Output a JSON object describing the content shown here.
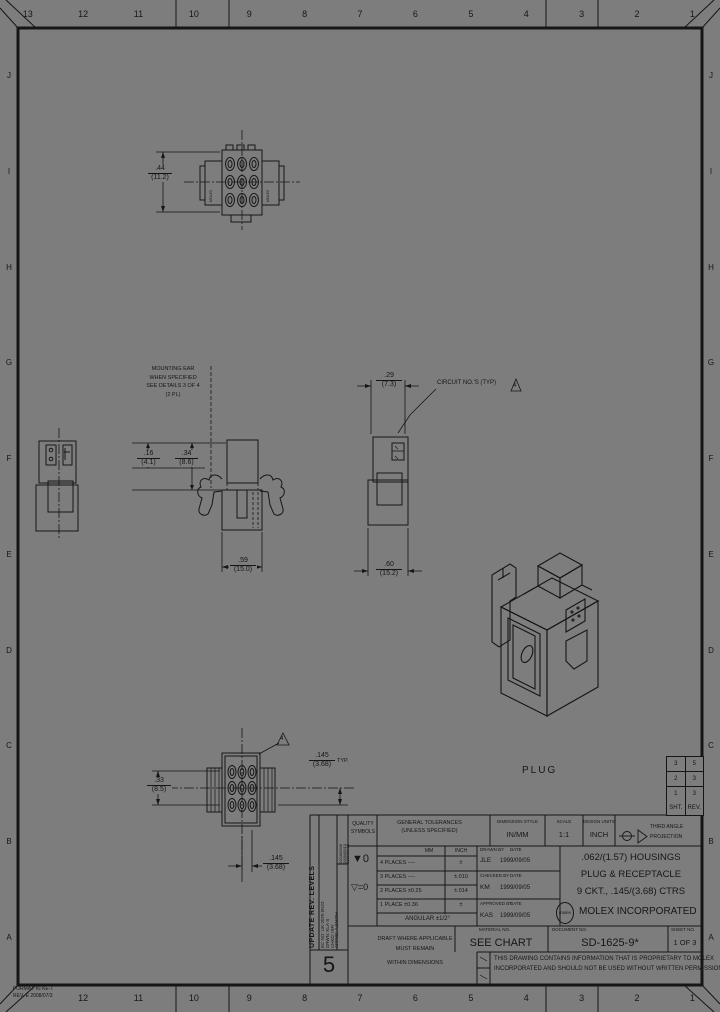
{
  "border": {
    "top_numbers": [
      "13",
      "12",
      "11",
      "10",
      "9",
      "8",
      "7",
      "6",
      "5",
      "4",
      "3",
      "2",
      "1"
    ],
    "bottom_numbers": [
      "",
      "12",
      "11",
      "10",
      "9",
      "8",
      "7",
      "6",
      "5",
      "4",
      "3",
      "2",
      "1"
    ],
    "left_letters": [
      "J",
      "I",
      "H",
      "G",
      "F",
      "E",
      "D",
      "C",
      "B",
      "A"
    ],
    "right_letters": [
      "J",
      "I",
      "H",
      "G",
      "F",
      "E",
      "D",
      "C",
      "B",
      "A"
    ]
  },
  "corner_note": {
    "line1": "FORMAT: KI KE-T",
    "line2": "REV. E 2008/07/3"
  },
  "views": {
    "receptacle_front": {
      "rail_left": "MOLEX",
      "rail_right": "MOLEX",
      "dim_width": {
        "in": ".44",
        "mm": "(11.2)"
      }
    },
    "mounting_note": {
      "lines": [
        "MOUNTING EAR",
        "WHEN SPECIFIED",
        "SEE DETAILS 3 OF 4",
        "(2 PL)"
      ]
    },
    "side_view": {
      "dim_a": {
        "in": ".16",
        "mm": "(4.1)"
      },
      "dim_b": {
        "in": ".34",
        "mm": "(8.6)"
      },
      "dim_bottom": {
        "in": ".59",
        "mm": "(15.0)"
      }
    },
    "pin_view": {
      "dim_top": {
        "in": ".29",
        "mm": "(7.3)"
      },
      "dim_bottom": {
        "in": ".60",
        "mm": "(15.2)"
      },
      "note": "CIRCUIT NO.'S (TYP)",
      "tri": "4"
    },
    "plug_front": {
      "dim_left": {
        "in": ".33",
        "mm": "(8.5)"
      },
      "dim_pitch": {
        "in": ".145",
        "mm": "(3.68)",
        "suffix": "TYP."
      },
      "dim_pitch2": {
        "in": ".145",
        "mm": "(3.68)"
      },
      "tri": "4"
    },
    "iso_label": "PLUG"
  },
  "rev_table": {
    "rows": [
      [
        "3",
        "5"
      ],
      [
        "2",
        "3"
      ],
      [
        "1",
        "3"
      ]
    ],
    "footer": {
      "sht": "SHT.",
      "rev": "REV."
    }
  },
  "title_block": {
    "update_strip": {
      "title": "UPDATE REV. LEVELS",
      "ec_no": "EC NO: UK-2070 0N23",
      "drwn": "DRWN: KLA-S",
      "chkd": "CHKD: ISFI",
      "appvd": "APPVD: A.SMITH",
      "dates": [
        "2004/09/06",
        "2009/09/13",
        "2009/09/15"
      ],
      "rev": "5"
    },
    "quality": {
      "header1": "QUALITY",
      "header2": "SYMBOLS",
      "sym1": "▼0",
      "sym2": "▽=0"
    },
    "tolerances": {
      "header1": "GENERAL TOLERANCES",
      "header2": "(UNLESS SPECIFIED)",
      "col_mm": "MM",
      "col_inch": "INCH",
      "rows": [
        [
          "4 PLACES ----",
          "±"
        ],
        [
          "3 PLACES ----",
          "±.010"
        ],
        [
          "2 PLACES ±0.25",
          "±.014"
        ],
        [
          "1 PLACE ±0.36",
          "±"
        ]
      ],
      "angular": "ANGULAR ±1/2°"
    },
    "dimension_style": {
      "label": "DIMENSION STYLE",
      "value": "IN/MM"
    },
    "scale": {
      "label": "SCALE",
      "value": "1:1"
    },
    "design_units": {
      "label": "DESIGN UNITS",
      "value": "INCH"
    },
    "projection": {
      "line1": "THIRD ANGLE",
      "line2": "PROJECTION"
    },
    "signatures": {
      "drawn_label": "DRAWN BY",
      "date_label": "DATE",
      "drawn_by": "JLE",
      "drawn_date": "1999/09/05",
      "checked_label": "CHECKED BY",
      "checked_by": "KM",
      "checked_date": "1999/09/05",
      "approved_label": "APPROVED BY",
      "approved_by": "KAS",
      "approved_date": "1999/09/05"
    },
    "title": {
      "line1": ".062/(1.57) HOUSINGS",
      "line2": "PLUG & RECEPTACLE",
      "line3": "9 CKT., .145/(3.68) CTRS"
    },
    "company": {
      "logo": "molex",
      "name": "MOLEX INCORPORATED"
    },
    "material": {
      "label": "MATERIAL NO.",
      "value": "SEE CHART"
    },
    "document": {
      "label": "DOCUMENT NO.",
      "value": "SD-1625-9*"
    },
    "sheet": {
      "label": "SHEET NO.",
      "value": "1 OF 3"
    },
    "draft_note": {
      "line1": "DRAFT WHERE APPLICABLE",
      "line2": "MUST REMAIN",
      "line3": "WITHIN DIMENSIONS"
    },
    "proprietary": {
      "line1": "THIS DRAWING CONTAINS INFORMATION THAT IS PROPRIETARY TO MOLEX",
      "line2": "INCORPORATED AND SHOULD NOT BE USED WITHOUT WRITTEN PERMISSION"
    }
  }
}
